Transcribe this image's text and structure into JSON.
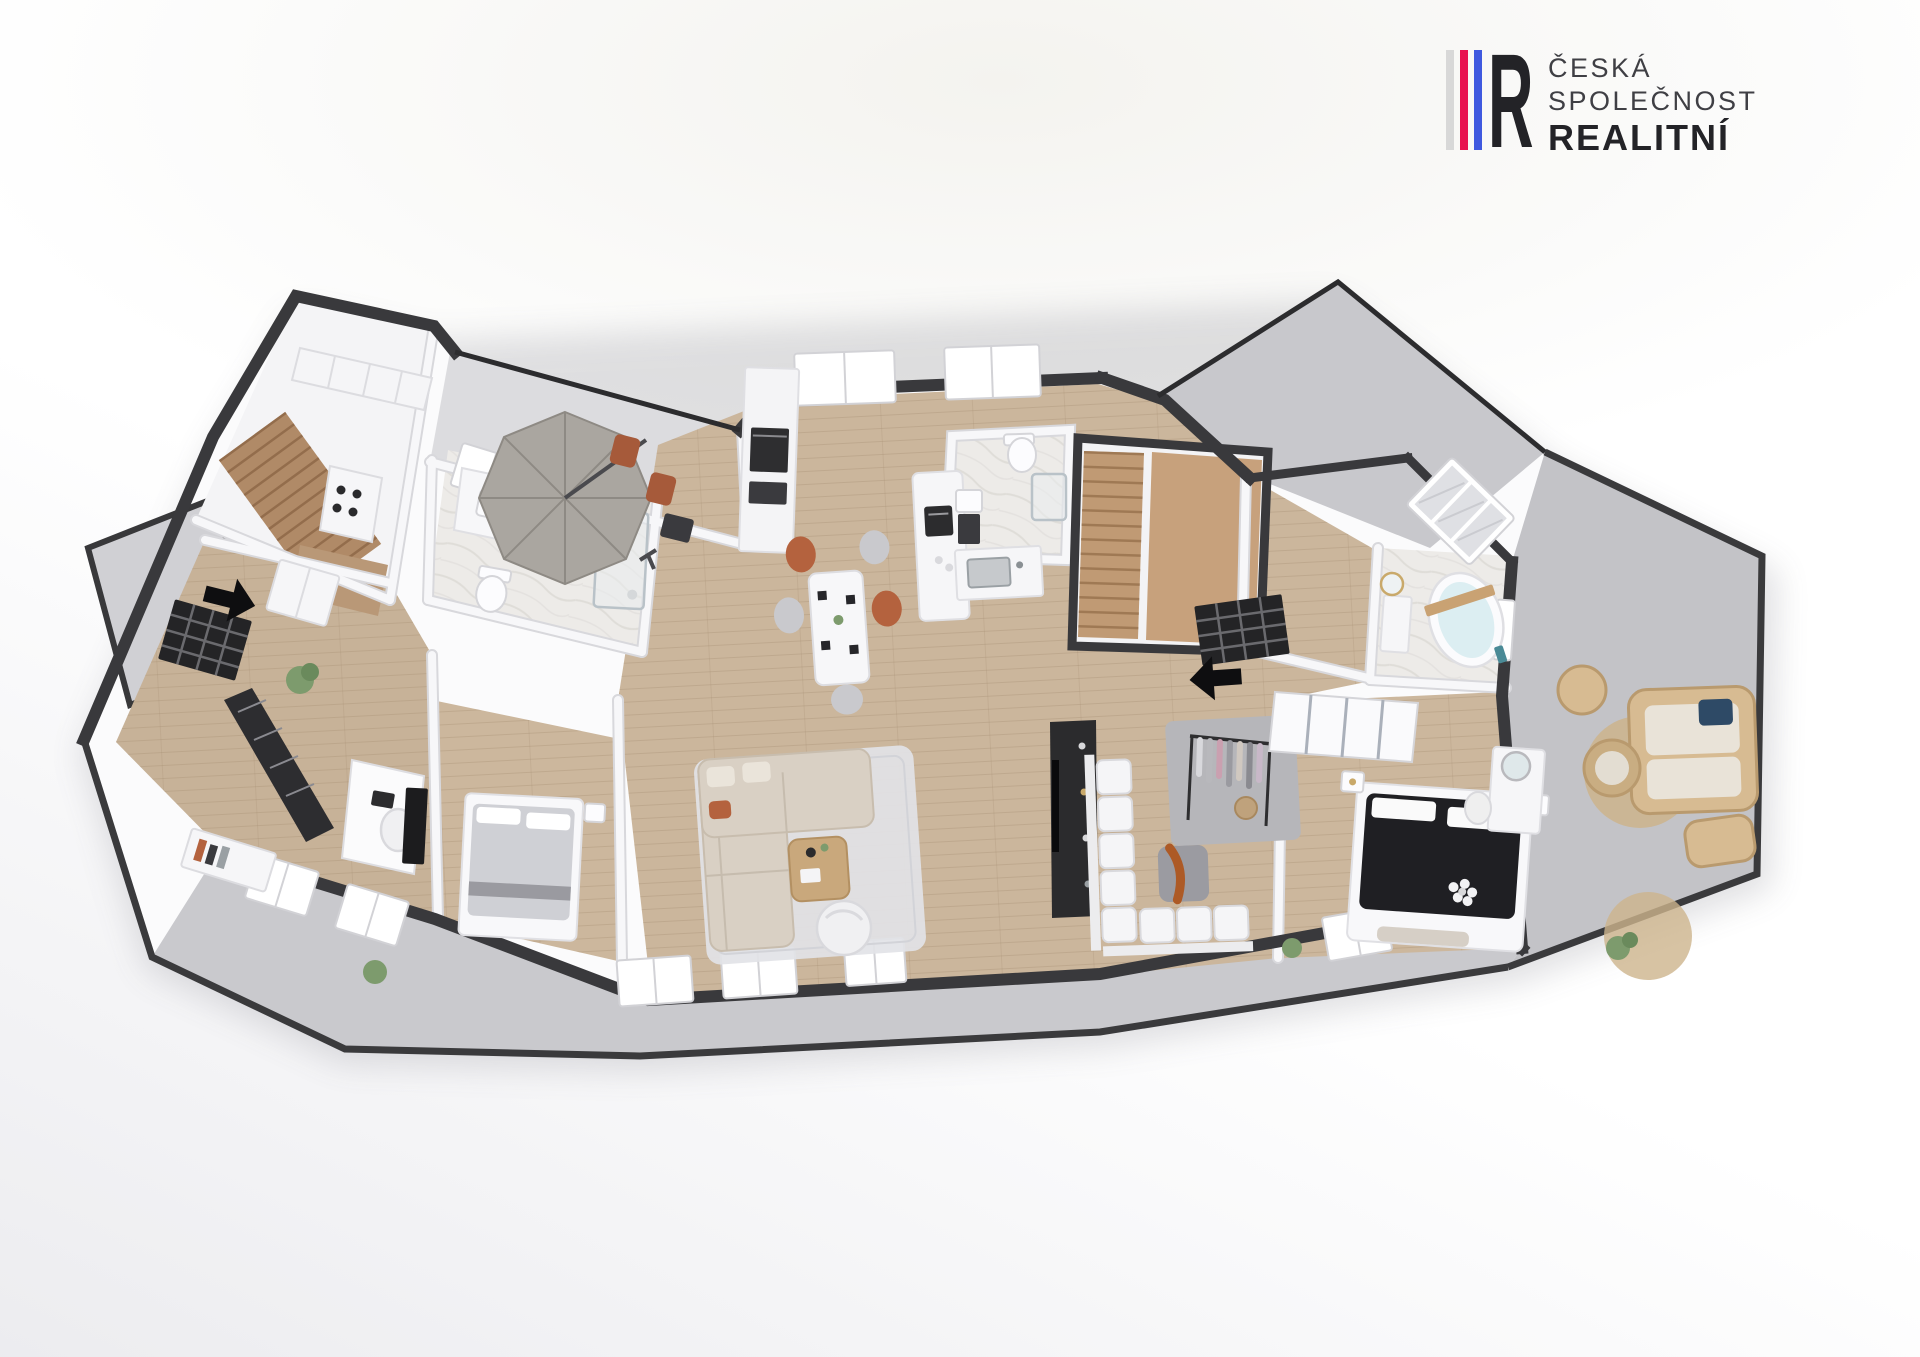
{
  "page": {
    "background": "#ffffff"
  },
  "logo": {
    "mark_letter": "R",
    "stripe_colors": [
      "#d8d8d8",
      "#e8134f",
      "#4059df"
    ],
    "mark_color": "#232327",
    "line1": "ČESKÁ",
    "line2": "SPOLEČNOST",
    "line3": "REALITNÍ",
    "text_color": "#3f3f44",
    "bold_text_color": "#232327"
  },
  "floor_plan": {
    "view": "3d-top-down-axonometric-render",
    "palette": {
      "exterior_wall": "#39393c",
      "interior_wall": "#f7f7f9",
      "wood_floor": "#cbb69c",
      "stair_wood": "#b08a67",
      "marble_floor": "#edebe8",
      "terrace_concrete": "#c6c6ca",
      "rug": "#e2e3e7",
      "sofa_beige": "#d9d0c4",
      "accent_chair_orange": "#b4623e",
      "dark_furniture": "#242428",
      "rattan": "#d7bb92",
      "entrance_arrow": "#0e0e10"
    },
    "rooms": [
      "staircase-hall-left",
      "kitchen",
      "dining-area",
      "entrance-hall-left",
      "bathroom-shower-left",
      "home-office",
      "bedroom-left",
      "living-room",
      "central-bathroom-wc",
      "staircase-right",
      "entrance-hall-right",
      "walk-in-closet",
      "lounge-seating-room",
      "master-bedroom",
      "bathroom-bathtub",
      "umbrella-terrace",
      "upper-right-terrace",
      "right-terrace",
      "bottom-balcony",
      "left-balcony"
    ],
    "furniture": [
      "patio-umbrella",
      "outdoor-chairs",
      "outdoor-side-table",
      "staircase-treads-left",
      "staircase-treads-right",
      "kitchen-upper-cabinets",
      "gas-hob",
      "tall-cabinet-oven",
      "kitchen-island",
      "coffee-machine",
      "kitchen-sink",
      "dining-table",
      "dining-chairs",
      "double-sink-vanity",
      "toilet",
      "walk-in-shower",
      "sectional-sofa",
      "coffee-table",
      "egg-chair",
      "area-rug",
      "media-wall-tv",
      "bookshelf",
      "desk",
      "office-chair",
      "sideboard",
      "double-bed-gray",
      "wall-tv",
      "nightstand",
      "modular-sofa-white",
      "ottoman",
      "clothes-rack",
      "laundry-basket",
      "sliding-wardrobe",
      "double-bed-dark",
      "flower-decor",
      "vanity-table",
      "vanity-stool",
      "bench",
      "freestanding-bathtub",
      "bath-caddy",
      "washbasin-vanity",
      "rattan-sofa",
      "rattan-armchair",
      "rattan-coffee-table",
      "rattan-lounger",
      "jute-rug",
      "potted-plants",
      "entry-wardrobe"
    ],
    "entrances": [
      {
        "side": "left",
        "arrow_direction": "right",
        "door": "black-grid-glass-door"
      },
      {
        "side": "center-right",
        "arrow_direction": "left",
        "door": "black-grid-glass-door"
      }
    ]
  }
}
